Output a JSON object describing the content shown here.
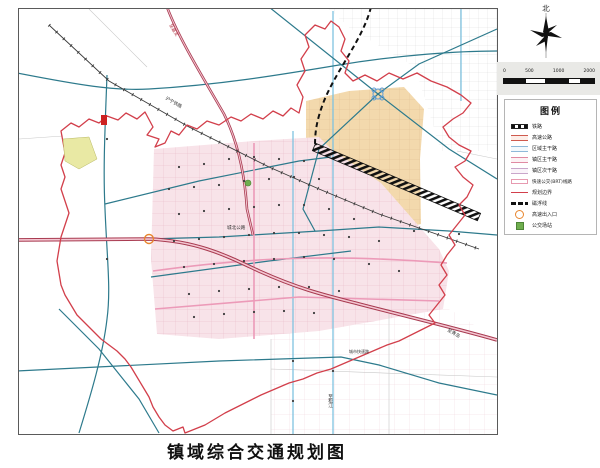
{
  "page": {
    "title": "镇域综合交通规划图"
  },
  "compass": {
    "label": "北"
  },
  "scalebar": {
    "ticks": [
      "0",
      "500",
      "1000",
      "2000"
    ]
  },
  "legend": {
    "title": "图例",
    "items": [
      {
        "id": "railway",
        "label": "铁路"
      },
      {
        "id": "expressway",
        "label": "高速公路"
      },
      {
        "id": "regional-road",
        "label": "区域主干路"
      },
      {
        "id": "town-main-road",
        "label": "镇区主干路"
      },
      {
        "id": "town-sec-road",
        "label": "镇区次干路"
      },
      {
        "id": "brt-line",
        "label": "快速公交(BRT)线路"
      },
      {
        "id": "plan-boundary",
        "label": "规划边界"
      },
      {
        "id": "maglev-line",
        "label": "磁浮线"
      },
      {
        "id": "expwy-exit",
        "label": "高速出入口"
      },
      {
        "id": "bus-depot",
        "label": "公交场站"
      }
    ]
  },
  "map_labels": {
    "to_jiading": "至嘉定",
    "railway_name": "沪宁铁路",
    "chengbei_road": "城北公路",
    "expwy_reserve": "城市快速路",
    "to_qingdao": "至青岛",
    "to_songjiang": "至松江"
  },
  "colors": {
    "boundary_red": "#d23f4b",
    "expressway_red": "#a83a50",
    "regional_teal": "#2d7a8c",
    "light_blue": "#7fc3e0",
    "brt_pink": "#ec9ab8",
    "town_fill": "#f8e3e9",
    "industry_fill": "#f3d9ad",
    "exit_orange": "#e8862e",
    "depot_green": "#6fae4e"
  }
}
